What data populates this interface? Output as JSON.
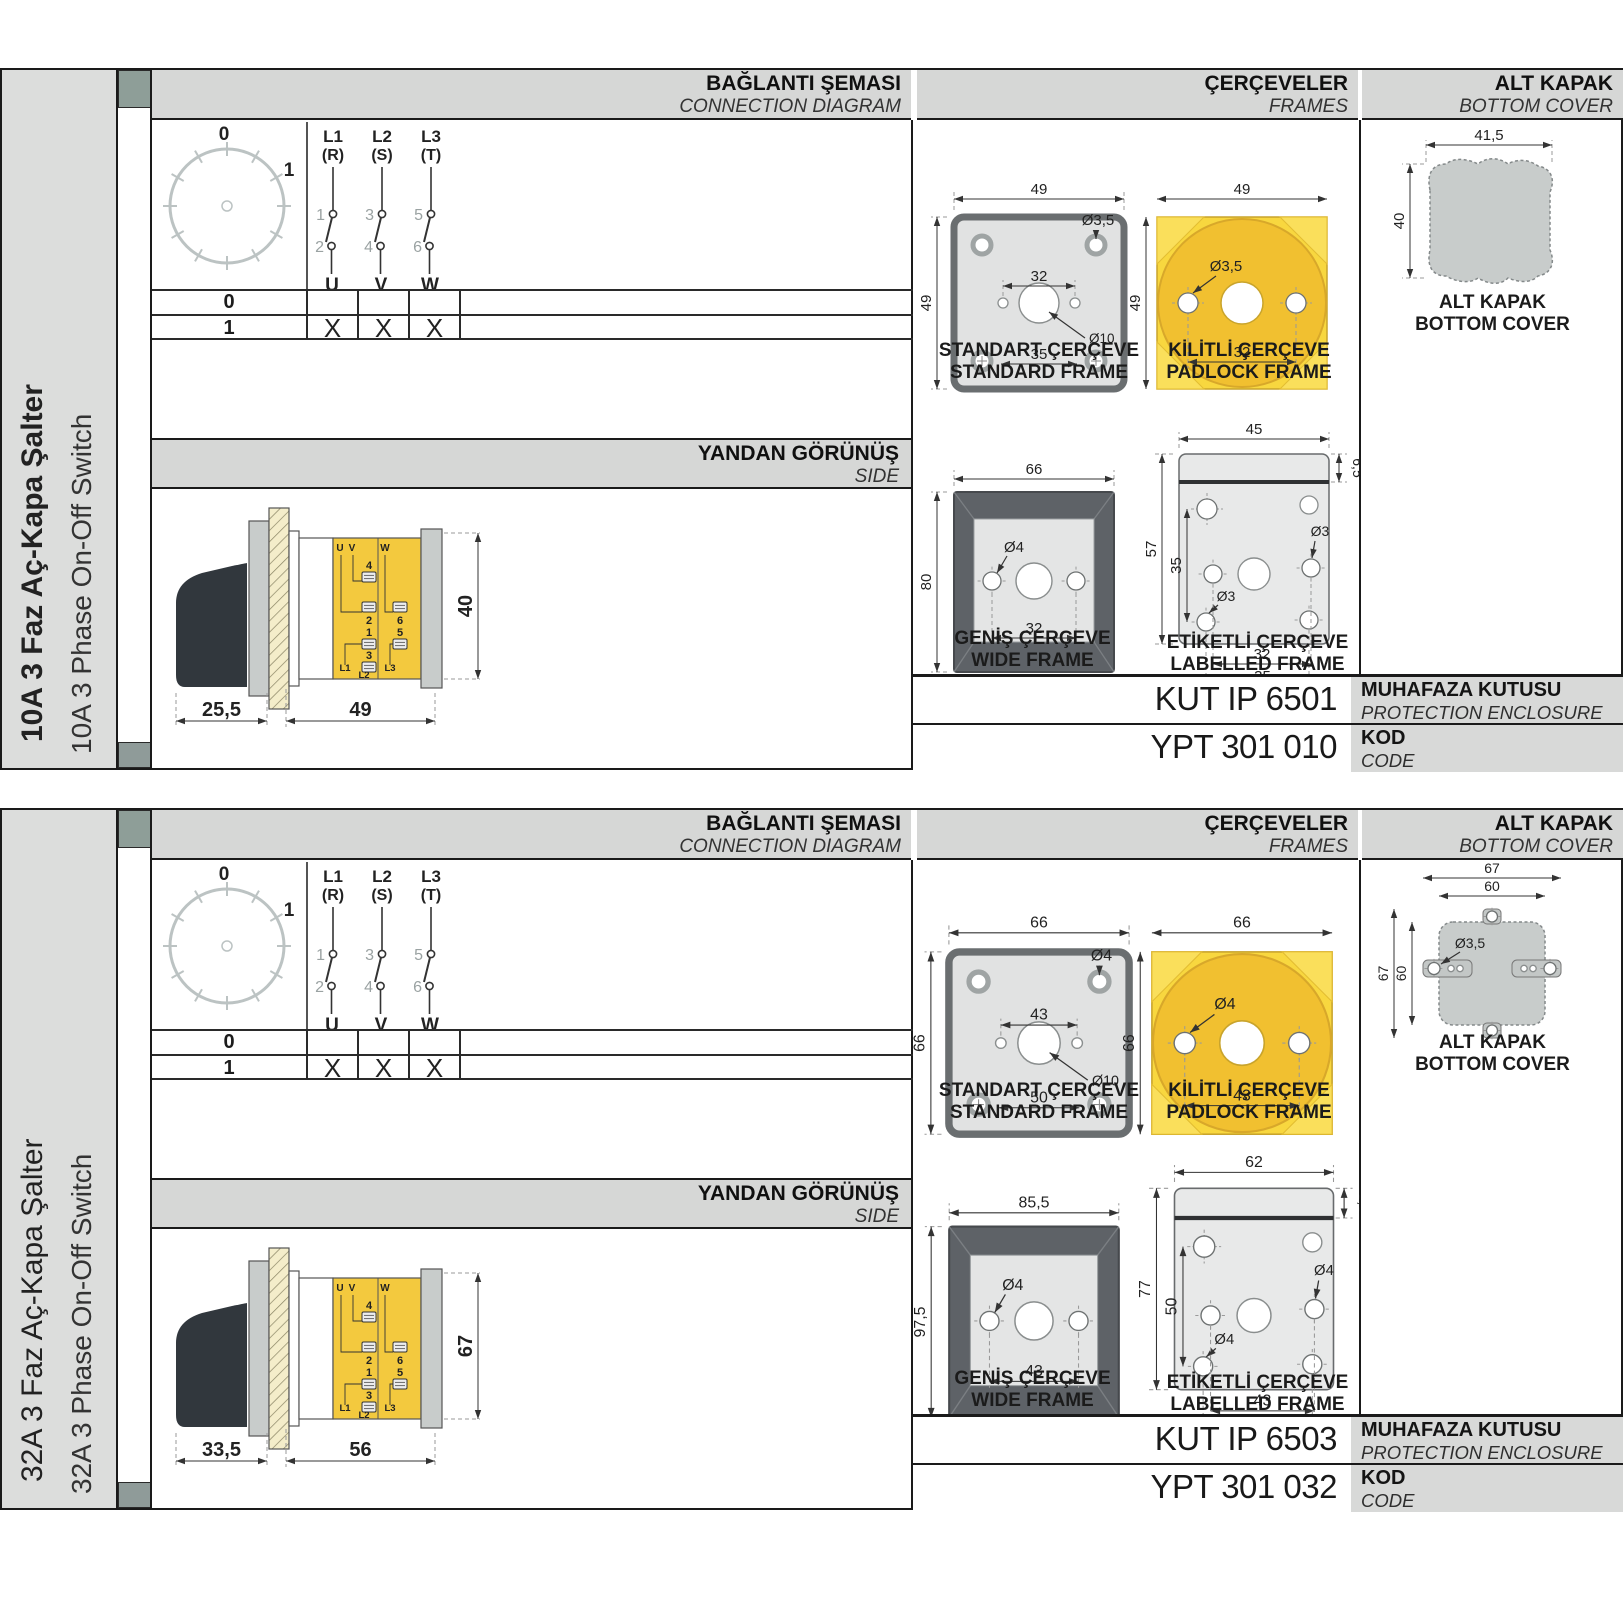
{
  "page": {
    "background": "#ffffff"
  },
  "colors": {
    "header_bg": "#d6d7d6",
    "sidebar_bg": "#dcdddc",
    "accent_yellow": "#f8d73f",
    "accent_gold": "#f1c030",
    "part_gray": "#c8cccb",
    "handle_dark": "#31373d",
    "frame_dark": "#5e6267",
    "border": "#1a1a1a",
    "tab_green": "#8e9e98"
  },
  "products": [
    {
      "sidebar": {
        "title_tr": "10A 3 Faz Aç-Kapa Şalter",
        "title_en": "10A 3 Phase On-Off Switch"
      },
      "headers": {
        "connection_tr": "BAĞLANTI ŞEMASI",
        "connection_en": "CONNECTION DIAGRAM",
        "frames_tr": "ÇERÇEVELER",
        "frames_en": "FRAMES",
        "cover_tr": "ALT KAPAK",
        "cover_en": "BOTTOM COVER",
        "side_tr": "YANDAN GÖRÜNÜŞ",
        "side_en": "SIDE"
      },
      "connection": {
        "dial": {
          "positions": [
            "0",
            "1"
          ]
        },
        "phases": [
          {
            "line": "L1",
            "phase": "(R)",
            "in": "1",
            "out": "2",
            "load": "U"
          },
          {
            "line": "L2",
            "phase": "(S)",
            "in": "3",
            "out": "4",
            "load": "V"
          },
          {
            "line": "L3",
            "phase": "(T)",
            "in": "5",
            "out": "6",
            "load": "W"
          }
        ],
        "table": {
          "rows": [
            {
              "pos": "0",
              "marks": [
                "",
                "",
                ""
              ]
            },
            {
              "pos": "1",
              "marks": [
                "X",
                "X",
                "X"
              ]
            }
          ]
        }
      },
      "side_view": {
        "dim_handle": "25,5",
        "dim_body": "49",
        "dim_height": "40",
        "terminals": {
          "u": "U",
          "v": "V",
          "w": "W",
          "n4": "4",
          "n2": "2",
          "n6": "6",
          "n1": "1",
          "n5": "5",
          "n3": "3",
          "l1": "L1",
          "l2": "L2",
          "l3": "L3"
        }
      },
      "frames": {
        "standard": {
          "caption_tr": "STANDART ÇERÇEVE",
          "caption_en": "STANDARD FRAME",
          "width": "49",
          "height": "49",
          "inner": "32",
          "outer": "35",
          "hole": "Ø3,5",
          "center": "Ø10"
        },
        "padlock": {
          "caption_tr": "KİLİTLİ ÇERÇEVE",
          "caption_en": "PADLOCK FRAME",
          "width": "49",
          "height": "49",
          "inner": "32",
          "hole": "Ø3,5"
        },
        "wide": {
          "caption_tr": "GENİŞ ÇERÇEVE",
          "caption_en": "WIDE FRAME",
          "width": "66",
          "height": "80",
          "inner": "32",
          "hole": "Ø4"
        },
        "labelled": {
          "caption_tr": "ETİKETLİ ÇERÇEVE",
          "caption_en": "LABELLED FRAME",
          "width": "45",
          "height": "57",
          "inner_height": "35",
          "inner": "32",
          "outer": "35",
          "top": "6,5",
          "hole": "Ø3"
        }
      },
      "cover": {
        "caption_tr": "ALT KAPAK",
        "caption_en": "BOTTOM COVER",
        "style": "blob",
        "dims_h": [
          "41,5"
        ],
        "dims_v": [
          "40"
        ]
      },
      "codes": {
        "enclosure_value": "KUT IP 6501",
        "enclosure_label_tr": "MUHAFAZA KUTUSU",
        "enclosure_label_en": "PROTECTION ENCLOSURE",
        "code_value": "YPT 301 010",
        "code_label_tr": "KOD",
        "code_label_en": "CODE"
      }
    },
    {
      "sidebar": {
        "title_tr": "32A 3 Faz Aç-Kapa Şalter",
        "title_en": "32A 3 Phase On-Off Switch"
      },
      "headers": {
        "connection_tr": "BAĞLANTI ŞEMASI",
        "connection_en": "CONNECTION DIAGRAM",
        "frames_tr": "ÇERÇEVELER",
        "frames_en": "FRAMES",
        "cover_tr": "ALT KAPAK",
        "cover_en": "BOTTOM COVER",
        "side_tr": "YANDAN GÖRÜNÜŞ",
        "side_en": "SIDE"
      },
      "connection": {
        "dial": {
          "positions": [
            "0",
            "1"
          ]
        },
        "phases": [
          {
            "line": "L1",
            "phase": "(R)",
            "in": "1",
            "out": "2",
            "load": "U"
          },
          {
            "line": "L2",
            "phase": "(S)",
            "in": "3",
            "out": "4",
            "load": "V"
          },
          {
            "line": "L3",
            "phase": "(T)",
            "in": "5",
            "out": "6",
            "load": "W"
          }
        ],
        "table": {
          "rows": [
            {
              "pos": "0",
              "marks": [
                "",
                "",
                ""
              ]
            },
            {
              "pos": "1",
              "marks": [
                "X",
                "X",
                "X"
              ]
            }
          ]
        }
      },
      "side_view": {
        "dim_handle": "33,5",
        "dim_body": "56",
        "dim_height": "67",
        "terminals": {
          "u": "U",
          "v": "V",
          "w": "W",
          "n4": "4",
          "n2": "2",
          "n6": "6",
          "n1": "1",
          "n5": "5",
          "n3": "3",
          "l1": "L1",
          "l2": "L2",
          "l3": "L3"
        }
      },
      "frames": {
        "standard": {
          "caption_tr": "STANDART ÇERÇEVE",
          "caption_en": "STANDARD FRAME",
          "width": "66",
          "height": "66",
          "inner": "43",
          "outer": "50",
          "hole": "Ø4",
          "center": "Ø10"
        },
        "padlock": {
          "caption_tr": "KİLİTLİ ÇERÇEVE",
          "caption_en": "PADLOCK FRAME",
          "width": "66",
          "height": "66",
          "inner": "43",
          "hole": "Ø4"
        },
        "wide": {
          "caption_tr": "GENİŞ ÇERÇEVE",
          "caption_en": "WIDE FRAME",
          "width": "85,5",
          "height": "97,5",
          "inner": "43",
          "hole": "Ø4"
        },
        "labelled": {
          "caption_tr": "ETİKETLİ ÇERÇEVE",
          "caption_en": "LABELLED FRAME",
          "width": "62",
          "height": "77",
          "inner_height": "50",
          "inner": "43",
          "outer": "50",
          "top": "9,5",
          "hole": "Ø4"
        }
      },
      "cover": {
        "caption_tr": "ALT KAPAK",
        "caption_en": "BOTTOM COVER",
        "style": "tabs",
        "dims_h": [
          "67",
          "60"
        ],
        "dims_v": [
          "67",
          "60"
        ],
        "hole": "Ø3,5"
      },
      "codes": {
        "enclosure_value": "KUT IP 6503",
        "enclosure_label_tr": "MUHAFAZA KUTUSU",
        "enclosure_label_en": "PROTECTION ENCLOSURE",
        "code_value": "YPT 301 032",
        "code_label_tr": "KOD",
        "code_label_en": "CODE"
      }
    }
  ]
}
